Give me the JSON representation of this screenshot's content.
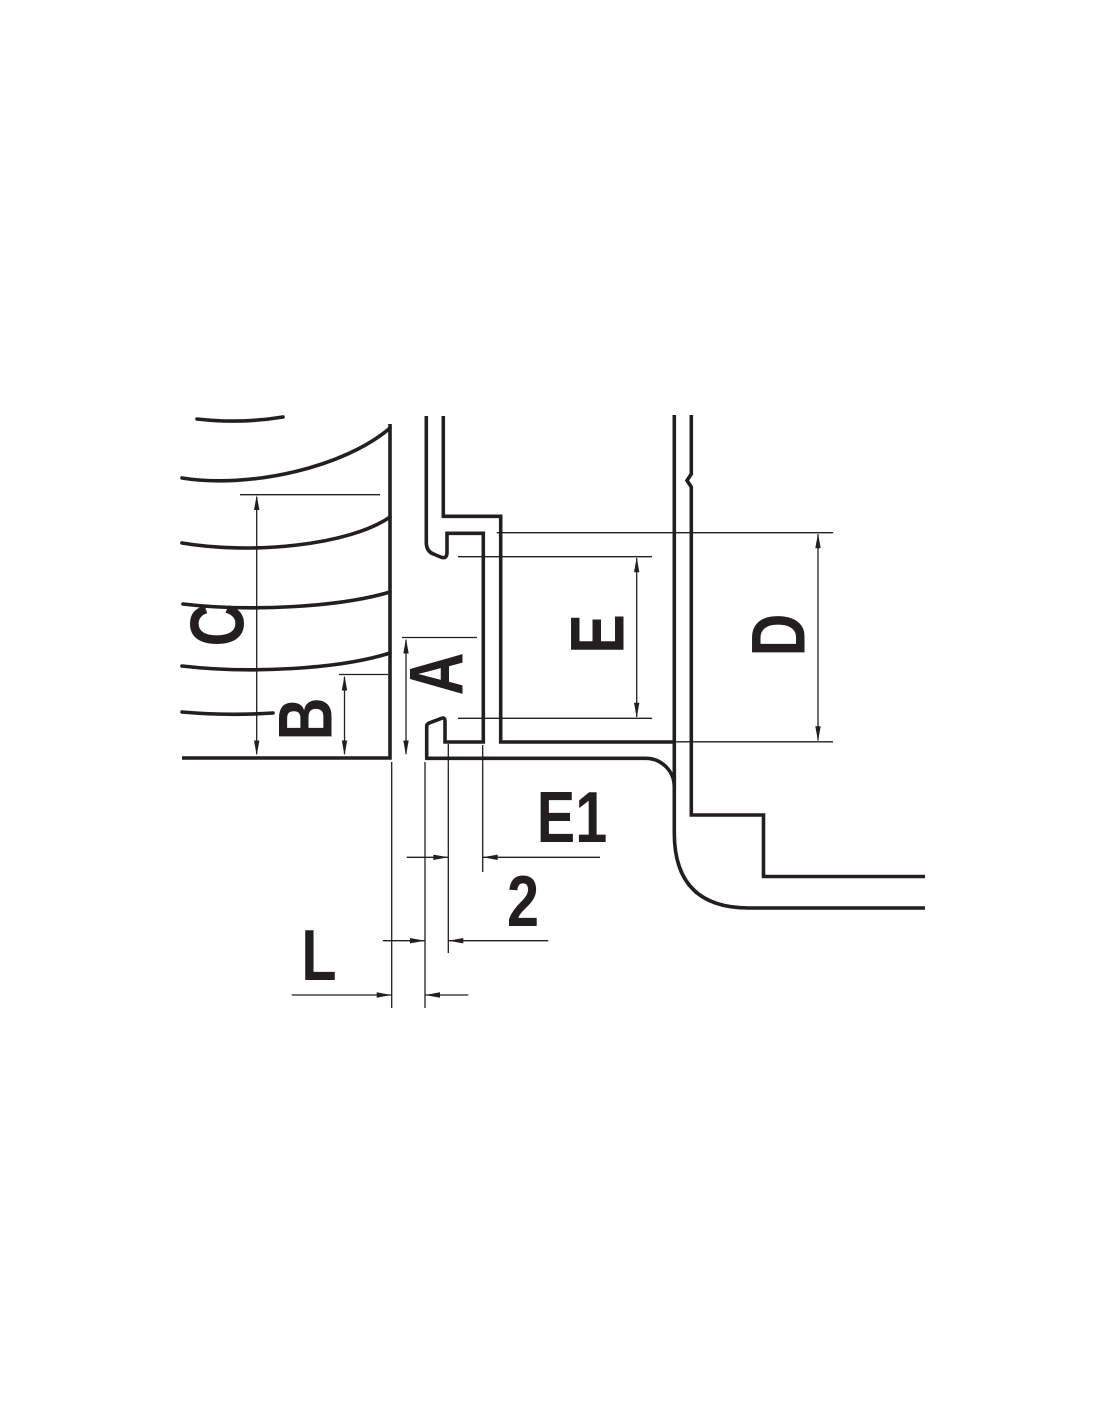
{
  "colors": {
    "line_color": "#231f20",
    "background_color": "#ffffff"
  },
  "drawing": {
    "type": "engineering-section-drawing",
    "dimension_labels": {
      "c": "C",
      "b": "B",
      "a": "A",
      "e": "E",
      "d": "D",
      "e1": "E1",
      "two": "2",
      "l": "L"
    }
  }
}
